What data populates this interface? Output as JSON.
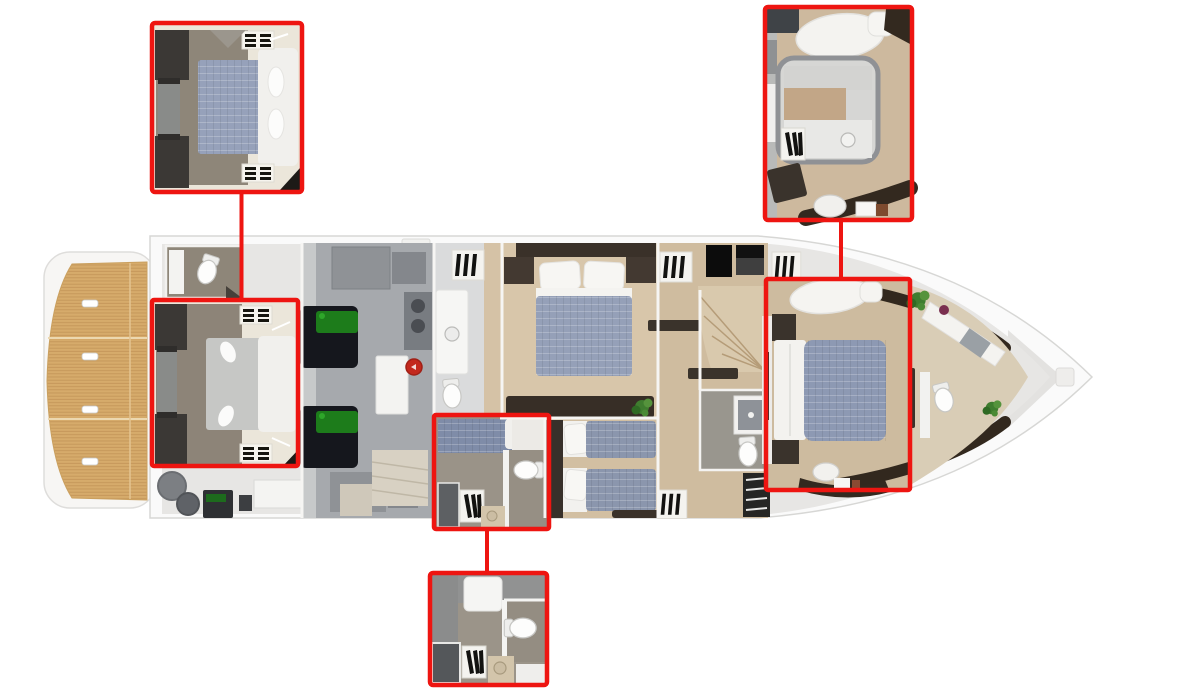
{
  "meta": {
    "kind": "yacht-lower-deck-floor-plan-with-callouts"
  },
  "colors": {
    "accent": "#ee1511",
    "hull": "#fafafa",
    "hull_line": "#d7d7d5",
    "teak": "#d6ab6b",
    "teak_line": "#c29457",
    "wood_floor": "#cdbb9f",
    "wood_floor_light": "#d8c6aa",
    "taupe_floor": "#8e8679",
    "engine_floor": "#a6a9ad",
    "tile_floor": "#dadbdc",
    "duvet_blue": "#95a0b8",
    "walnut": "#33291f",
    "cream": "#ebe6da",
    "engine_green": "#1d7c1b",
    "engine_dark": "#15171d",
    "extinguisher_red": "#c3281d",
    "plant_green": "#3f7d2f"
  },
  "callouts": {
    "aft_cabin": {
      "inset_position": "top-left"
    },
    "bow_cabin": {
      "inset_position": "top-right"
    },
    "crew_bathroom": {
      "inset_position": "bottom-center"
    }
  },
  "regions": [
    "swim-platform",
    "aft-cabin",
    "aft-bathroom",
    "engine-room",
    "galley",
    "crew-cabin",
    "guest-cabin-midship",
    "twin-cabin",
    "corridor-stairs",
    "mid-bathroom",
    "vip-cabin-bow",
    "bow-bathroom"
  ]
}
